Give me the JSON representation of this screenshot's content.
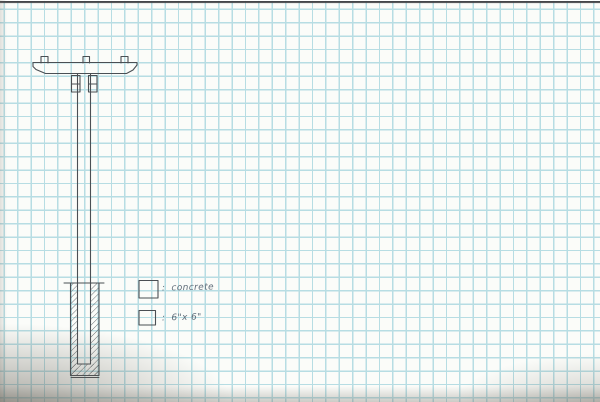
{
  "legend": {
    "items": [
      {
        "name": "concrete-hatch",
        "separator": ":",
        "label": "concrete"
      },
      {
        "name": "post-size",
        "separator": ":",
        "label": "6\"x 6\""
      }
    ]
  },
  "colors": {
    "paper": "#fbfcf9",
    "grid": "#b7dde3",
    "pencil": "#4a4f54",
    "ink": "#5f6c79",
    "edge": "#45464a"
  }
}
